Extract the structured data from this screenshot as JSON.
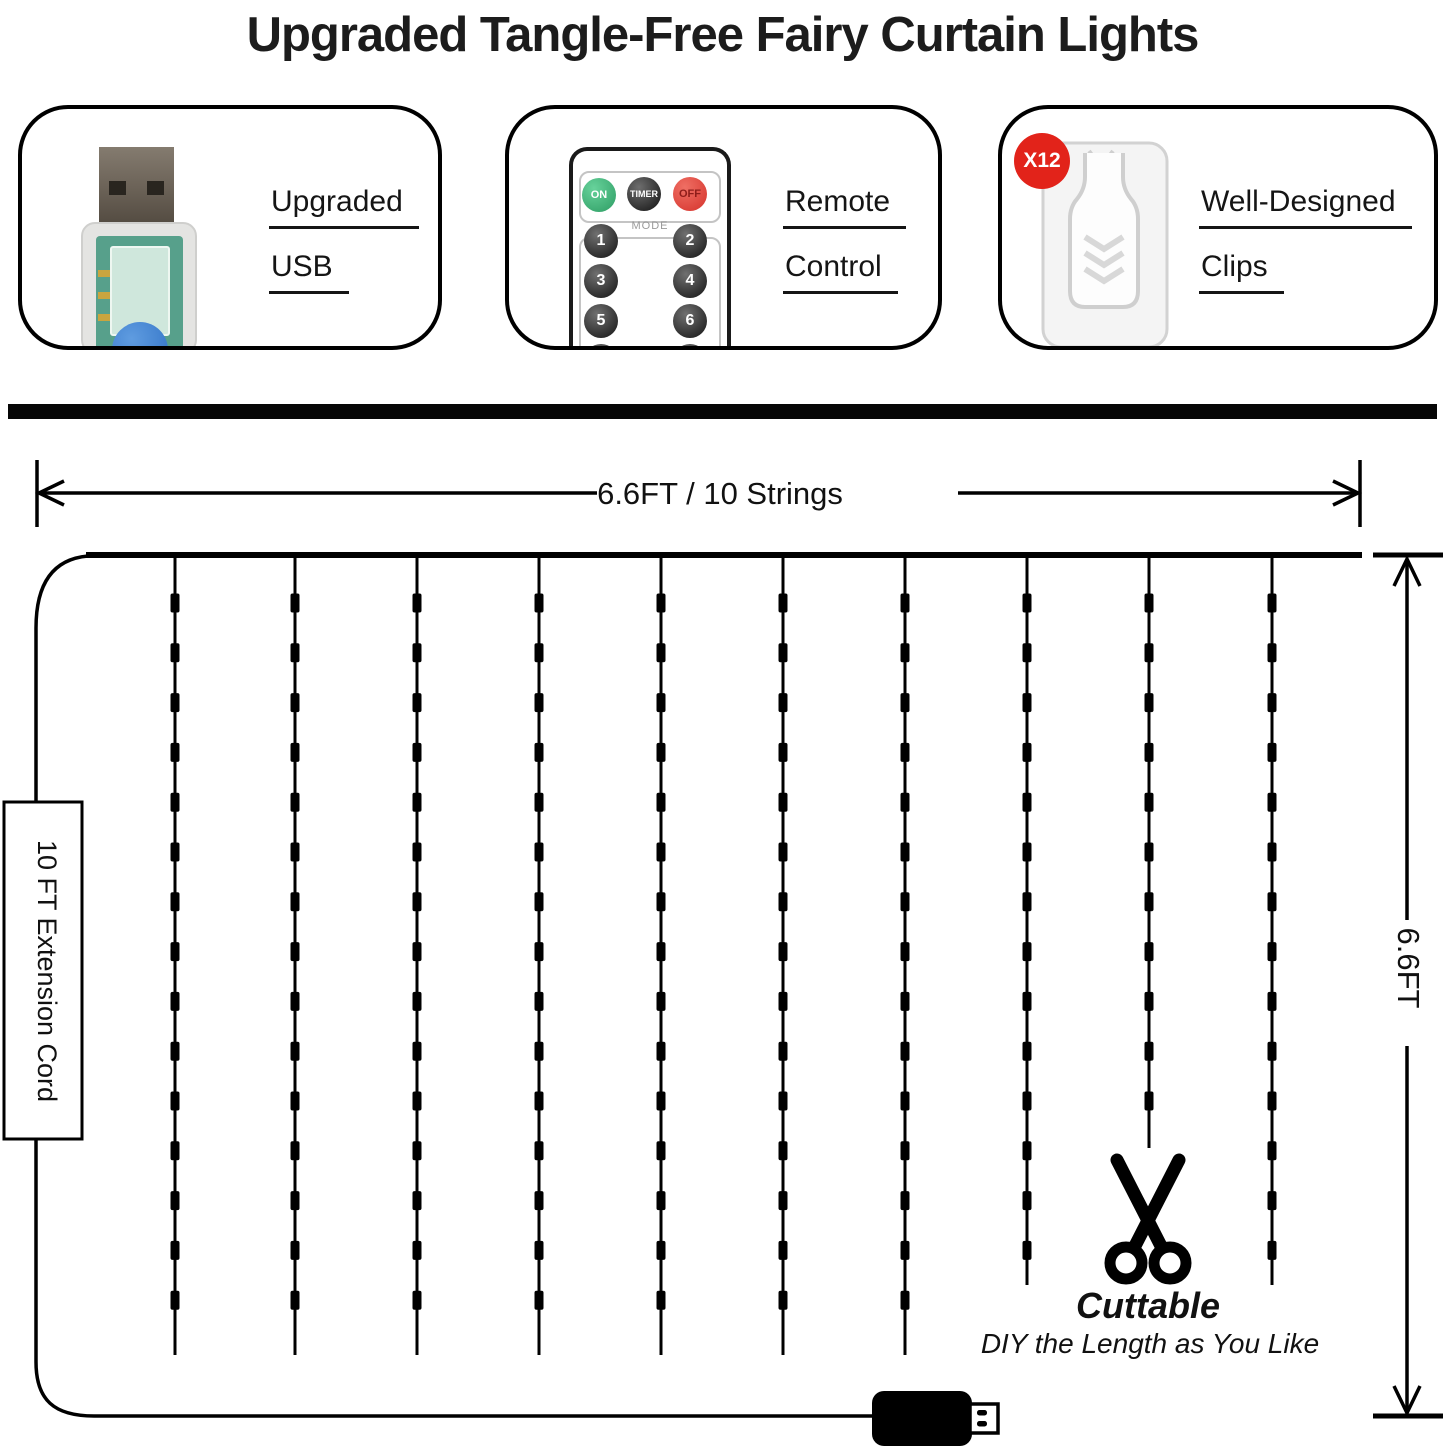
{
  "title": "Upgraded Tangle-Free Fairy Curtain Lights",
  "features": [
    {
      "id": "usb",
      "line1": "Upgraded",
      "line2": "USB"
    },
    {
      "id": "remote",
      "line1": "Remote",
      "line2": "Control"
    },
    {
      "id": "clips",
      "line1": "Well-Designed",
      "line2": "Clips",
      "badge": "X12"
    }
  ],
  "remote": {
    "power_buttons": [
      "ON",
      "TIMER",
      "OFF"
    ],
    "mode_label": "MODE",
    "mode_buttons": [
      "1",
      "2",
      "3",
      "4",
      "5",
      "6",
      "7",
      "8"
    ]
  },
  "dimensions": {
    "width_label": "6.6FT / 10 Strings",
    "height_label": "6.6FT",
    "cord_label": "10 FT Extension Cord"
  },
  "cuttable": {
    "title": "Cuttable",
    "subtitle": "DIY the Length as You Like"
  },
  "curtain": {
    "string_count": 10,
    "top_y": 555,
    "led_first_y": 603,
    "led_step": 49.8,
    "strings": [
      {
        "x": 175,
        "bottom": 1355,
        "leds": 15
      },
      {
        "x": 295,
        "bottom": 1355,
        "leds": 15
      },
      {
        "x": 417,
        "bottom": 1355,
        "leds": 15
      },
      {
        "x": 539,
        "bottom": 1355,
        "leds": 15
      },
      {
        "x": 661,
        "bottom": 1355,
        "leds": 15
      },
      {
        "x": 783,
        "bottom": 1355,
        "leds": 15
      },
      {
        "x": 905,
        "bottom": 1355,
        "leds": 15
      },
      {
        "x": 1027,
        "bottom": 1285,
        "leds": 14
      },
      {
        "x": 1149,
        "bottom": 1148,
        "leds": 11,
        "cut": true
      },
      {
        "x": 1272,
        "bottom": 1285,
        "leds": 14
      }
    ]
  },
  "colors": {
    "ink": "#111111",
    "badge_red": "#e2231a",
    "button_green": "#3eba7c",
    "button_red": "#e4403a"
  }
}
